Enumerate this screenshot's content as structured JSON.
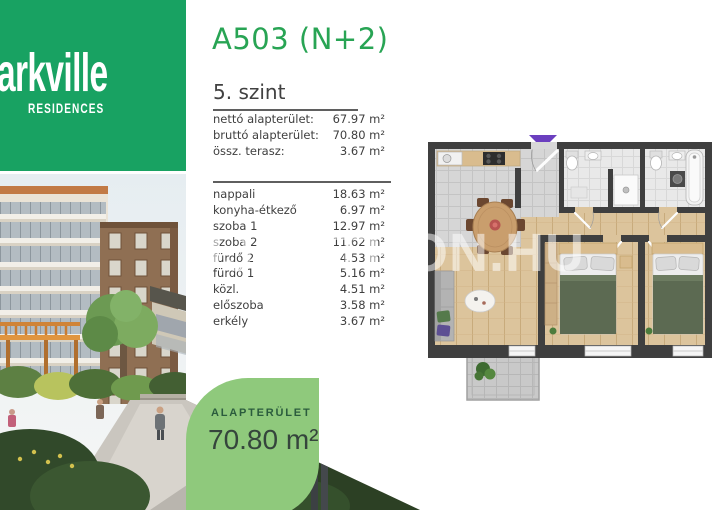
{
  "brand": {
    "name": "arkville",
    "subtitle": "RESIDENCES"
  },
  "header": {
    "unit": "A503 (N+2)",
    "floor": "5. szint"
  },
  "summary": {
    "rows": [
      {
        "label": "nettó alapterület:",
        "value": "67.97 m²"
      },
      {
        "label": "bruttó alapterület:",
        "value": "70.80 m²"
      },
      {
        "label": "össz. terasz:",
        "value": "3.67 m²"
      }
    ]
  },
  "rooms": {
    "rows": [
      {
        "label": "nappali",
        "value": "18.63 m²"
      },
      {
        "label": "konyha-étkező",
        "value": "6.97 m²"
      },
      {
        "label": "szoba 1",
        "value": "12.97 m²"
      },
      {
        "label": "szoba 2",
        "value": "11.62 m²"
      },
      {
        "label": "fürdő 2",
        "value": "4.53 m²"
      },
      {
        "label": "fürdő 1",
        "value": "5.16 m²"
      },
      {
        "label": "közl.",
        "value": "4.51 m²"
      },
      {
        "label": "előszoba",
        "value": "3.58 m²"
      },
      {
        "label": "erkély",
        "value": "3.67 m²"
      }
    ]
  },
  "area_badge": {
    "label": "ALAPTERÜLET",
    "value": "70.80 m²"
  },
  "watermark": {
    "text": "UJOTTHON.HU"
  },
  "colors": {
    "brand_green": "#18a262",
    "title_green": "#28a454",
    "leaf_green": "#8fc97c",
    "badge_label_green": "#2b5c3d",
    "wall_dark": "#3f3f3f",
    "wood_floor": "#dcc49c",
    "entry_marker_purple": "#6b3fbf"
  }
}
